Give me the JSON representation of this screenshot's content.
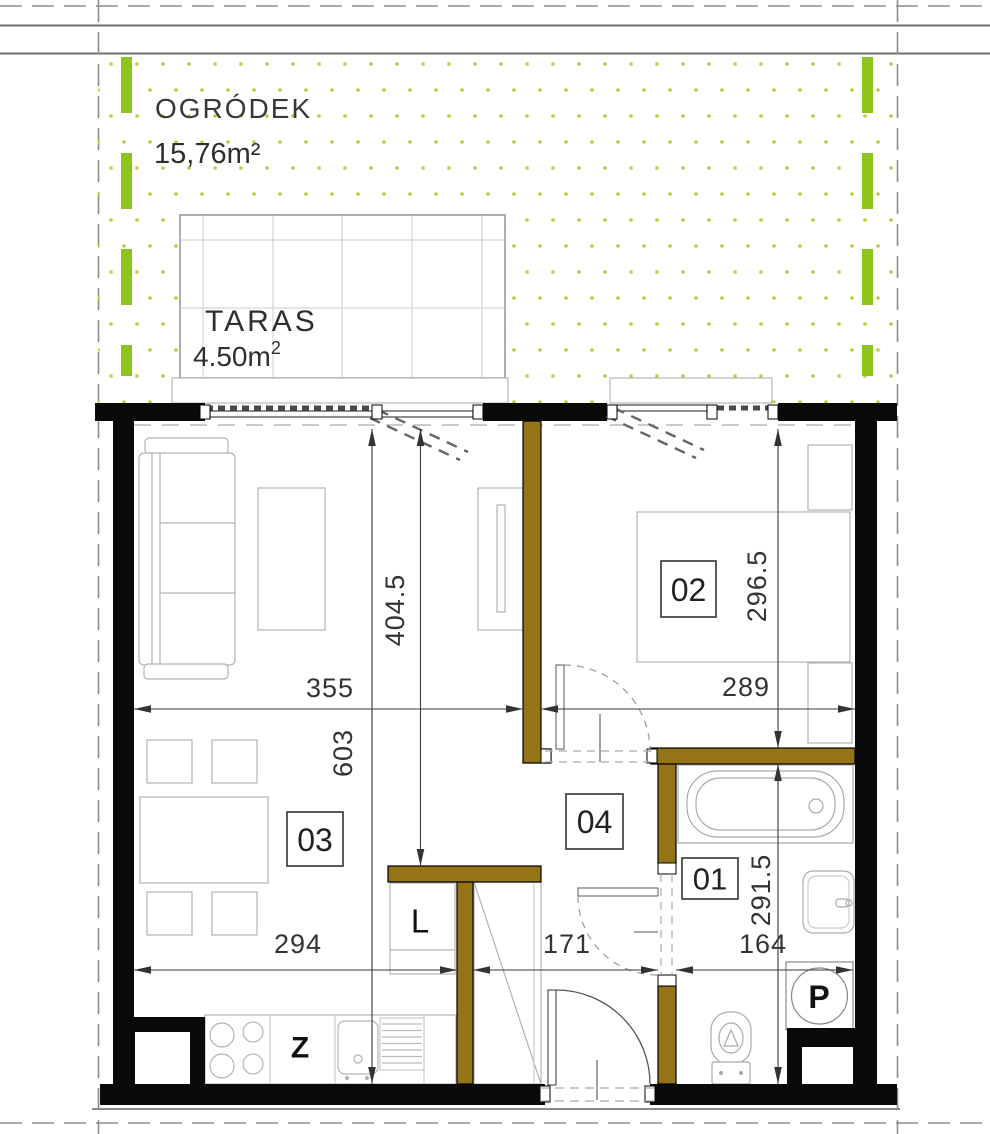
{
  "plan": {
    "garden": {
      "name": "OGRÓDEK",
      "area": "15,76m²"
    },
    "terrace": {
      "name": "TARAS",
      "area_base": "4.50m",
      "area_exponent": "2"
    },
    "rooms": {
      "bathroom": {
        "number": "01"
      },
      "bedroom": {
        "number": "02"
      },
      "living": {
        "number": "03"
      },
      "hall": {
        "number": "04"
      }
    },
    "fixtures": {
      "fridge_label": "L",
      "kitchen_label": "Z",
      "washer_label": "P"
    },
    "dimensions": {
      "living_width_cm": "355",
      "living_depth_cm": "404.5",
      "apartment_depth_cm": "603",
      "bedroom_width_cm": "289",
      "bedroom_depth_cm": "296.5",
      "dining_width_cm": "294",
      "hall_width_cm": "171",
      "bathroom_width_cm": "164",
      "bathroom_depth_cm": "291.5"
    },
    "colors": {
      "exterior_wall": "#0a0a0a",
      "partition_wall": "#957417",
      "boundary_green": "#8fc41f",
      "garden_dot": "#b9cf37"
    }
  }
}
